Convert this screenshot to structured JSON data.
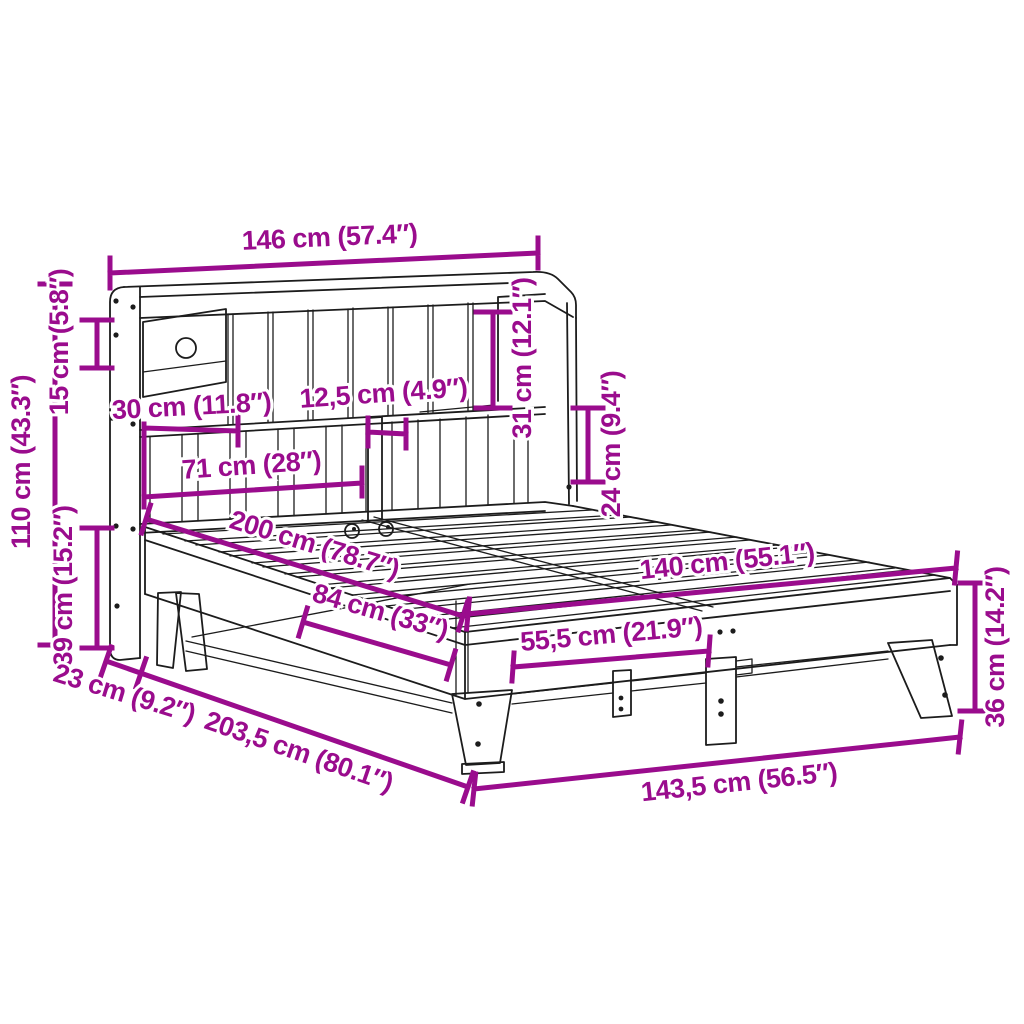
{
  "diagram": {
    "title": "bed-frame-with-bookshelf-headboard-dimension-diagram",
    "accent_color": "#9a0c8d",
    "line_color": "#1c1c1c",
    "background_color": "#ffffff",
    "dimensions": [
      {
        "id": "headboard-width",
        "label": "146 cm (57.4″)"
      },
      {
        "id": "headboard-height",
        "label": "110 cm (43.3″)"
      },
      {
        "id": "top-shelf-height",
        "label": "15 cm (5.8″)"
      },
      {
        "id": "base-height",
        "label": "39 cm (15.2″)"
      },
      {
        "id": "shelf-section-width",
        "label": "30 cm (11.8″)"
      },
      {
        "id": "slot-width",
        "label": "12,5 cm (4.9″)"
      },
      {
        "id": "shelf-span-width",
        "label": "71 cm (28″)"
      },
      {
        "id": "shelf-opening-height",
        "label": "31 cm (12.1″)"
      },
      {
        "id": "lower-opening-height",
        "label": "24 cm (9.4″)"
      },
      {
        "id": "bed-length",
        "label": "200 cm (78.7″)"
      },
      {
        "id": "bed-width",
        "label": "140 cm (55.1″)"
      },
      {
        "id": "side-rail-length",
        "label": "84 cm (33″)"
      },
      {
        "id": "leg-spacing",
        "label": "55,5 cm (21.9″)"
      },
      {
        "id": "foot-end-height",
        "label": "36 cm (14.2″)"
      },
      {
        "id": "headboard-depth",
        "label": "23 cm (9.2″)"
      },
      {
        "id": "total-length",
        "label": "203,5 cm (80.1″)"
      },
      {
        "id": "outer-width",
        "label": "143,5 cm (56.5″)"
      }
    ]
  }
}
